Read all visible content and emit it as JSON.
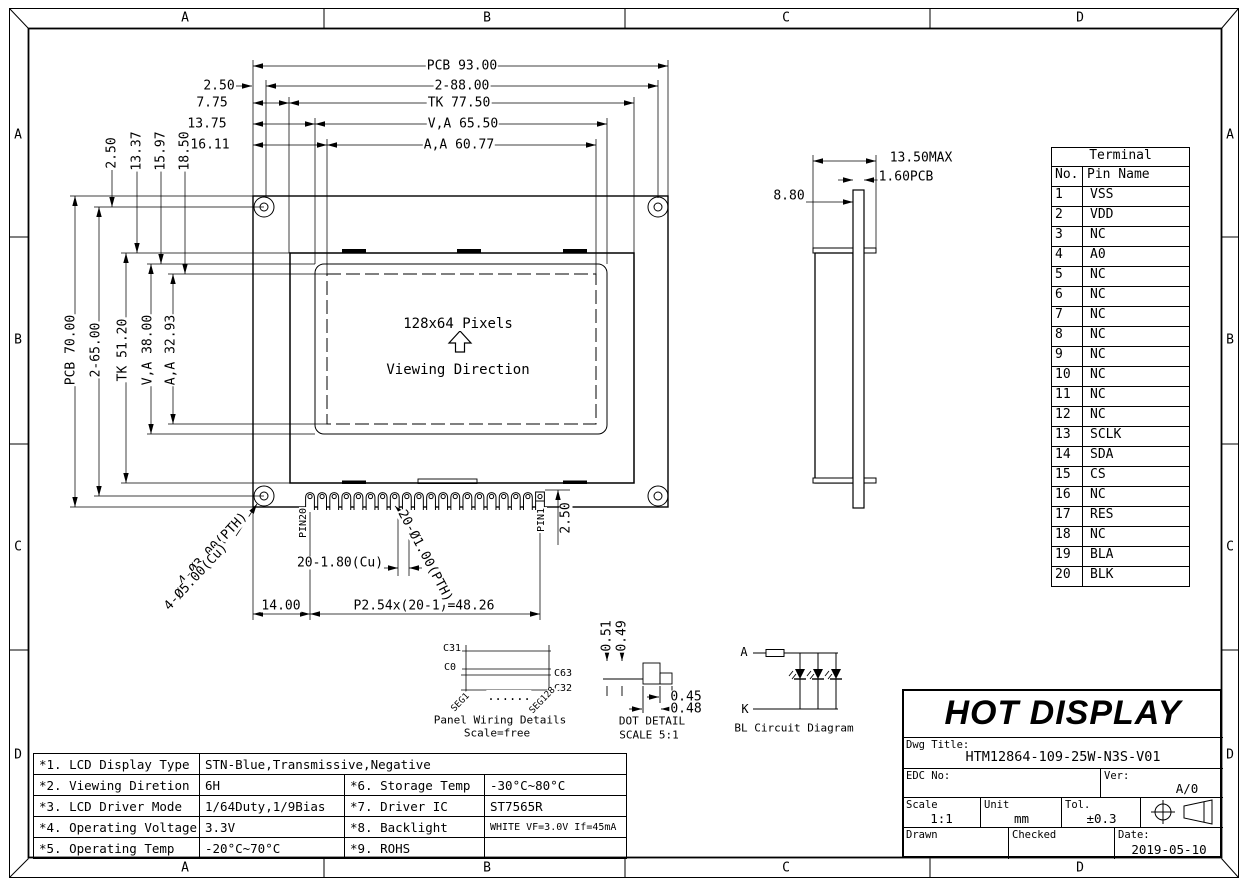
{
  "sheet": {
    "zone_letters": [
      "A",
      "B",
      "C",
      "D"
    ]
  },
  "front_view": {
    "pixels_label": "128x64 Pixels",
    "viewing_label": "Viewing Direction"
  },
  "labels": [
    {
      "n": "dim-pcb-width",
      "t": "PCB 93.00",
      "x": 462,
      "y": 66
    },
    {
      "n": "dim-hole-span-h",
      "t": "2-88.00",
      "x": 462,
      "y": 86
    },
    {
      "n": "dim-hole-offset-h",
      "t": "2.50",
      "x": 219,
      "y": 86
    },
    {
      "n": "dim-tk-width",
      "t": "TK 77.50",
      "x": 459,
      "y": 103
    },
    {
      "n": "dim-tk-offset-h",
      "t": "7.75",
      "x": 212,
      "y": 103
    },
    {
      "n": "dim-va-width",
      "t": "V,A 65.50",
      "x": 463,
      "y": 124
    },
    {
      "n": "dim-va-offset-h",
      "t": "13.75",
      "x": 207,
      "y": 124
    },
    {
      "n": "dim-aa-width",
      "t": "A,A 60.77",
      "x": 459,
      "y": 145
    },
    {
      "n": "dim-aa-offset-h",
      "t": "16.11",
      "x": 210,
      "y": 145
    },
    {
      "n": "dim-hole-offset-v",
      "t": "2.50",
      "x": 112,
      "y": 153,
      "r": -90
    },
    {
      "n": "dim-tk-offset-v",
      "t": "13.37",
      "x": 137,
      "y": 151,
      "r": -90
    },
    {
      "n": "dim-va-offset-v",
      "t": "15.97",
      "x": 161,
      "y": 151,
      "r": -90
    },
    {
      "n": "dim-aa-offset-v",
      "t": "18.50",
      "x": 185,
      "y": 151,
      "r": -90
    },
    {
      "n": "dim-pcb-height",
      "t": "PCB 70.00",
      "x": 71,
      "y": 350,
      "r": -90
    },
    {
      "n": "dim-hole-span-v",
      "t": "2-65.00",
      "x": 96,
      "y": 350,
      "r": -90
    },
    {
      "n": "dim-tk-height",
      "t": "TK 51.20",
      "x": 123,
      "y": 350,
      "r": -90
    },
    {
      "n": "dim-va-height",
      "t": "V,A 38.00",
      "x": 148,
      "y": 350,
      "r": -90
    },
    {
      "n": "dim-aa-height",
      "t": "A,A 32.93",
      "x": 171,
      "y": 350,
      "r": -90
    },
    {
      "n": "display-pixels-label",
      "t": "128x64 Pixels",
      "x": 458,
      "y": 324,
      "s": 14
    },
    {
      "n": "viewing-direction-label",
      "t": "Viewing Direction",
      "x": 458,
      "y": 370,
      "s": 14
    },
    {
      "n": "pin20-label",
      "t": "PIN20",
      "x": 304,
      "y": 523,
      "r": -90,
      "s": 10
    },
    {
      "n": "pin1-label",
      "t": "PIN1",
      "x": 542,
      "y": 520,
      "r": -90,
      "s": 10
    },
    {
      "n": "dim-pin-margin",
      "t": "14.00",
      "x": 281,
      "y": 606
    },
    {
      "n": "dim-pin-pitch",
      "t": "P2.54x(20-1)=48.26",
      "x": 424,
      "y": 606
    },
    {
      "n": "dim-pad-width",
      "t": "20-1.80(Cu)",
      "x": 340,
      "y": 563
    },
    {
      "n": "dim-pin-hole",
      "t": "20-Ø1.00(PTH)",
      "x": 425,
      "y": 556,
      "r": 62
    },
    {
      "n": "dim-mount-hole-pth",
      "t": "4-Ø3.00(PTH)",
      "x": 213,
      "y": 549,
      "r": -47
    },
    {
      "n": "dim-mount-hole-cu",
      "t": "4-Ø5.00(Cu)",
      "x": 196,
      "y": 577,
      "r": -47
    },
    {
      "n": "dim-pin-protrude",
      "t": "2.50",
      "x": 566,
      "y": 518,
      "r": -90
    },
    {
      "n": "dim-total-thickness",
      "t": "13.50MAX",
      "x": 921,
      "y": 158
    },
    {
      "n": "dim-pcb-thickness",
      "t": "1.60PCB",
      "x": 906,
      "y": 177
    },
    {
      "n": "dim-body-depth",
      "t": "8.80",
      "x": 789,
      "y": 196
    },
    {
      "n": "wiring-c31",
      "t": "C31",
      "x": 452,
      "y": 649,
      "s": 10
    },
    {
      "n": "wiring-c0",
      "t": "C0",
      "x": 450,
      "y": 668,
      "s": 10
    },
    {
      "n": "wiring-c63",
      "t": "C63",
      "x": 563,
      "y": 674,
      "s": 10
    },
    {
      "n": "wiring-c32",
      "t": "C32",
      "x": 563,
      "y": 689,
      "s": 10
    },
    {
      "n": "wiring-dots",
      "t": "......",
      "x": 509,
      "y": 696,
      "s": 12
    },
    {
      "n": "wiring-seg1",
      "t": "SEG1",
      "x": 461,
      "y": 703,
      "r": -46,
      "s": 9
    },
    {
      "n": "wiring-seg128",
      "t": "SEG128",
      "x": 543,
      "y": 701,
      "r": -46,
      "s": 9
    },
    {
      "n": "wiring-title",
      "t": "Panel Wiring Details",
      "x": 500,
      "y": 720,
      "s": 11
    },
    {
      "n": "wiring-scale",
      "t": "Scale=free",
      "x": 497,
      "y": 733,
      "s": 11
    },
    {
      "n": "dot-dim-051",
      "t": "0.51",
      "x": 607,
      "y": 636,
      "r": -90
    },
    {
      "n": "dot-dim-049",
      "t": "0.49",
      "x": 622,
      "y": 636,
      "r": -90
    },
    {
      "n": "dot-dim-045",
      "t": "0.45",
      "x": 686,
      "y": 697
    },
    {
      "n": "dot-dim-048",
      "t": "0.48",
      "x": 686,
      "y": 709
    },
    {
      "n": "dot-detail-title",
      "t": "DOT DETAIL",
      "x": 652,
      "y": 721,
      "s": 11
    },
    {
      "n": "dot-detail-scale",
      "t": "SCALE 5:1",
      "x": 649,
      "y": 735,
      "s": 11
    },
    {
      "n": "bl-anode-label",
      "t": "A",
      "x": 744,
      "y": 652,
      "s": 12
    },
    {
      "n": "bl-cathode-label",
      "t": "K",
      "x": 745,
      "y": 709,
      "s": 12
    },
    {
      "n": "bl-circuit-title",
      "t": "BL Circuit Diagram",
      "x": 794,
      "y": 728,
      "s": 11
    }
  ],
  "terminal_table": {
    "title": "Terminal",
    "col_no": "No.",
    "col_pin": "Pin Name",
    "rows": [
      [
        "1",
        "VSS"
      ],
      [
        "2",
        "VDD"
      ],
      [
        "3",
        "NC"
      ],
      [
        "4",
        "A0"
      ],
      [
        "5",
        "NC"
      ],
      [
        "6",
        "NC"
      ],
      [
        "7",
        "NC"
      ],
      [
        "8",
        "NC"
      ],
      [
        "9",
        "NC"
      ],
      [
        "10",
        "NC"
      ],
      [
        "11",
        "NC"
      ],
      [
        "12",
        "NC"
      ],
      [
        "13",
        "SCLK"
      ],
      [
        "14",
        "SDA"
      ],
      [
        "15",
        "CS"
      ],
      [
        "16",
        "NC"
      ],
      [
        "17",
        "RES"
      ],
      [
        "18",
        "NC"
      ],
      [
        "19",
        "BLA"
      ],
      [
        "20",
        "BLK"
      ]
    ]
  },
  "spec_table": {
    "rows": [
      [
        "*1. LCD Display Type",
        "STN-Blue,Transmissive,Negative",
        "",
        ""
      ],
      [
        "*2. Viewing Diretion",
        "6H",
        "*6. Storage Temp",
        "-30°C~80°C"
      ],
      [
        "*3. LCD Driver Mode",
        "1/64Duty,1/9Bias",
        "*7. Driver IC",
        "ST7565R"
      ],
      [
        "*4. Operating Voltage",
        "3.3V",
        "*8. Backlight",
        "WHITE VF=3.0V If=45mA"
      ],
      [
        "*5. Operating Temp",
        "-20°C~70°C",
        "*9. ROHS",
        ""
      ]
    ]
  },
  "title_block": {
    "company": "HOT DISPLAY",
    "dwg_title_label": "Dwg Title:",
    "dwg_title": "HTM12864-109-25W-N3S-V01",
    "edc_label": "EDC No:",
    "ver_label": "Ver:",
    "ver": "A/0",
    "scale_label": "Scale",
    "scale": "1:1",
    "unit_label": "Unit",
    "unit": "mm",
    "tol_label": "Tol.",
    "tol": "±0.3",
    "drawn_label": "Drawn",
    "checked_label": "Checked",
    "date_label": "Date:",
    "date": "2019-05-10"
  }
}
